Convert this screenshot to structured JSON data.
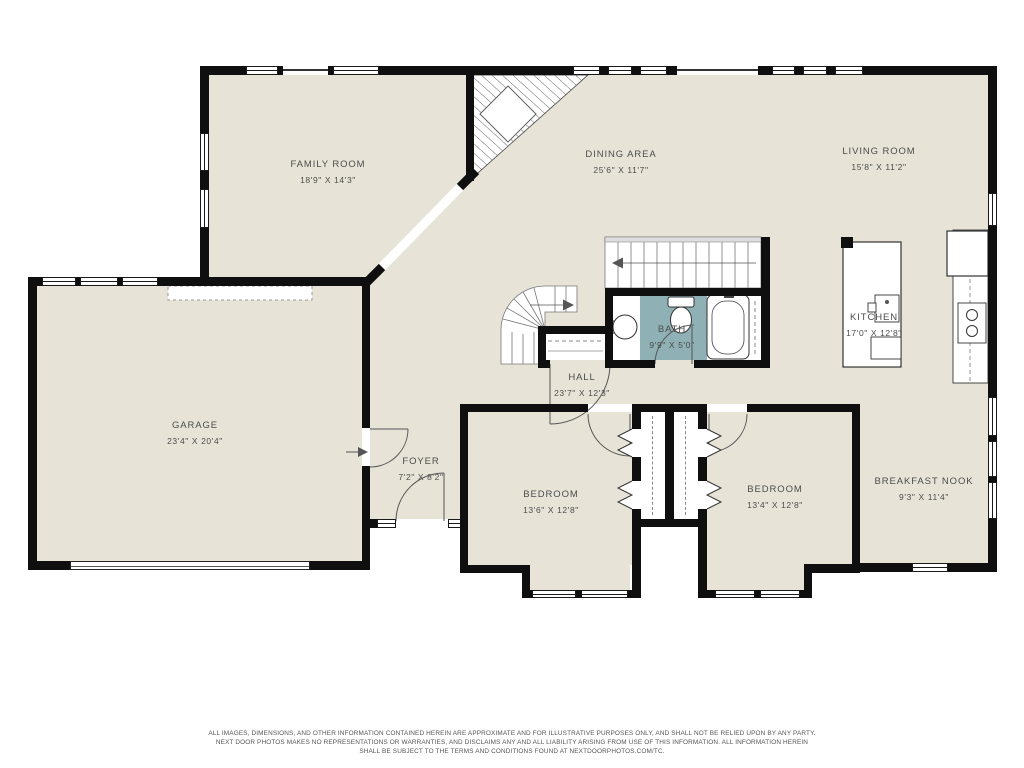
{
  "title": "Main floor plan",
  "colors": {
    "floor": "#e7e4d7",
    "wall": "#0f0f0f",
    "bath_tile": "#8fb0b5",
    "line": "#555555",
    "label_text": "#4c4c4c"
  },
  "rooms": [
    {
      "id": "family-room",
      "name": "FAMILY ROOM",
      "dims": "18'9\" X 14'3\""
    },
    {
      "id": "dining-area",
      "name": "DINING AREA",
      "dims": "25'6\" X 11'7\""
    },
    {
      "id": "living-room",
      "name": "LIVING ROOM",
      "dims": "15'8\" X 11'2\""
    },
    {
      "id": "garage",
      "name": "GARAGE",
      "dims": "23'4\" X 20'4\""
    },
    {
      "id": "foyer",
      "name": "FOYER",
      "dims": "7'2\" X 8'2\""
    },
    {
      "id": "hall",
      "name": "HALL",
      "dims": "23'7\" X 12'3\""
    },
    {
      "id": "bath",
      "name": "BATH",
      "dims": "9'9\" X 5'0\""
    },
    {
      "id": "kitchen",
      "name": "KITCHEN",
      "dims": "17'0\" X 12'8\""
    },
    {
      "id": "bedroom-left",
      "name": "BEDROOM",
      "dims": "13'6\" X 12'8\""
    },
    {
      "id": "bedroom-right",
      "name": "BEDROOM",
      "dims": "13'4\" X 12'8\""
    },
    {
      "id": "breakfast-nook",
      "name": "BREAKFAST NOOK",
      "dims": "9'3\" X 11'4\""
    }
  ],
  "disclaimer": {
    "line1": "ALL IMAGES, DIMENSIONS, AND OTHER INFORMATION CONTAINED HEREIN ARE APPROXIMATE AND FOR ILLUSTRATIVE PURPOSES ONLY, AND SHALL NOT BE RELIED UPON BY ANY PARTY.",
    "line2": "NEXT DOOR PHOTOS MAKES NO REPRESENTATIONS OR WARRANTIES, AND DISCLAIMS ANY AND ALL LIABILITY ARISING FROM USE OF THIS INFORMATION. ALL INFORMATION HEREIN",
    "line3": "SHALL BE SUBJECT TO THE TERMS AND CONDITIONS FOUND AT NEXTDOORPHOTOS.COM/TC."
  }
}
